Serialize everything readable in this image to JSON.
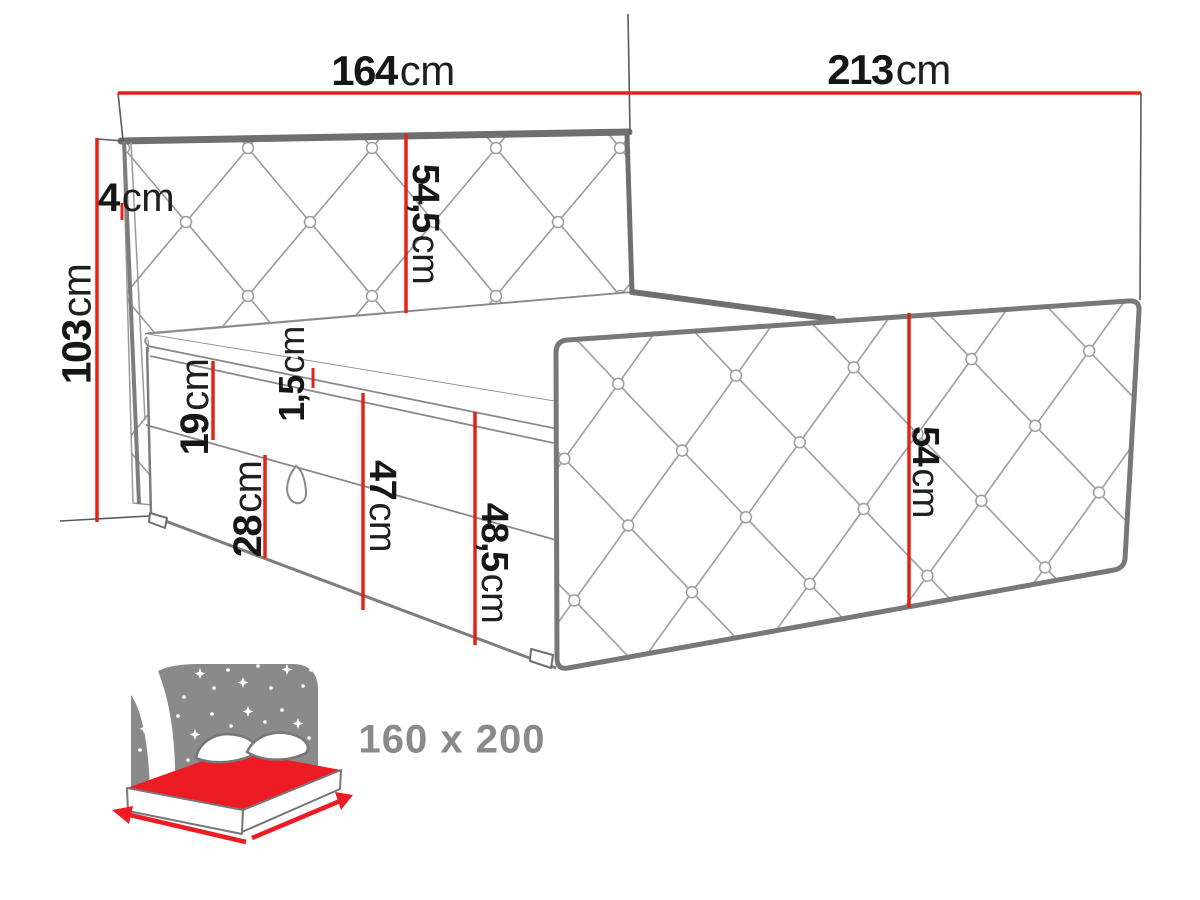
{
  "diagram_type": "bed-dimension-drawing",
  "dimensions": {
    "headboard_width": {
      "value": "164",
      "unit": "cm"
    },
    "bed_length": {
      "value": "213",
      "unit": "cm"
    },
    "headboard_thickness": {
      "value": "4",
      "unit": "cm"
    },
    "total_height": {
      "value": "103",
      "unit": "cm"
    },
    "headboard_panel_height": {
      "value": "54,5",
      "unit": "cm"
    },
    "mattress_rim_gap": {
      "value": "1,5",
      "unit": "cm"
    },
    "top_box_height": {
      "value": "19",
      "unit": "cm"
    },
    "storage_box_height": {
      "value": "28",
      "unit": "cm"
    },
    "base_height": {
      "value": "47",
      "unit": "cm"
    },
    "base_with_rim_height": {
      "value": "48,5",
      "unit": "cm"
    },
    "side_panel_height": {
      "value": "54",
      "unit": "cm"
    }
  },
  "size_badge": {
    "label": "160 x 200"
  },
  "icon": {
    "name": "bed-with-starry-headboard"
  },
  "colors": {
    "dimension_red": "#e2231a",
    "label_text": "#161616",
    "quilt_line_gray": "#9b9b9b",
    "edge_gray": "#6f6f6f",
    "icon_gray": "#8a8a8a",
    "icon_red": "#ed1c24",
    "background": "#ffffff"
  }
}
